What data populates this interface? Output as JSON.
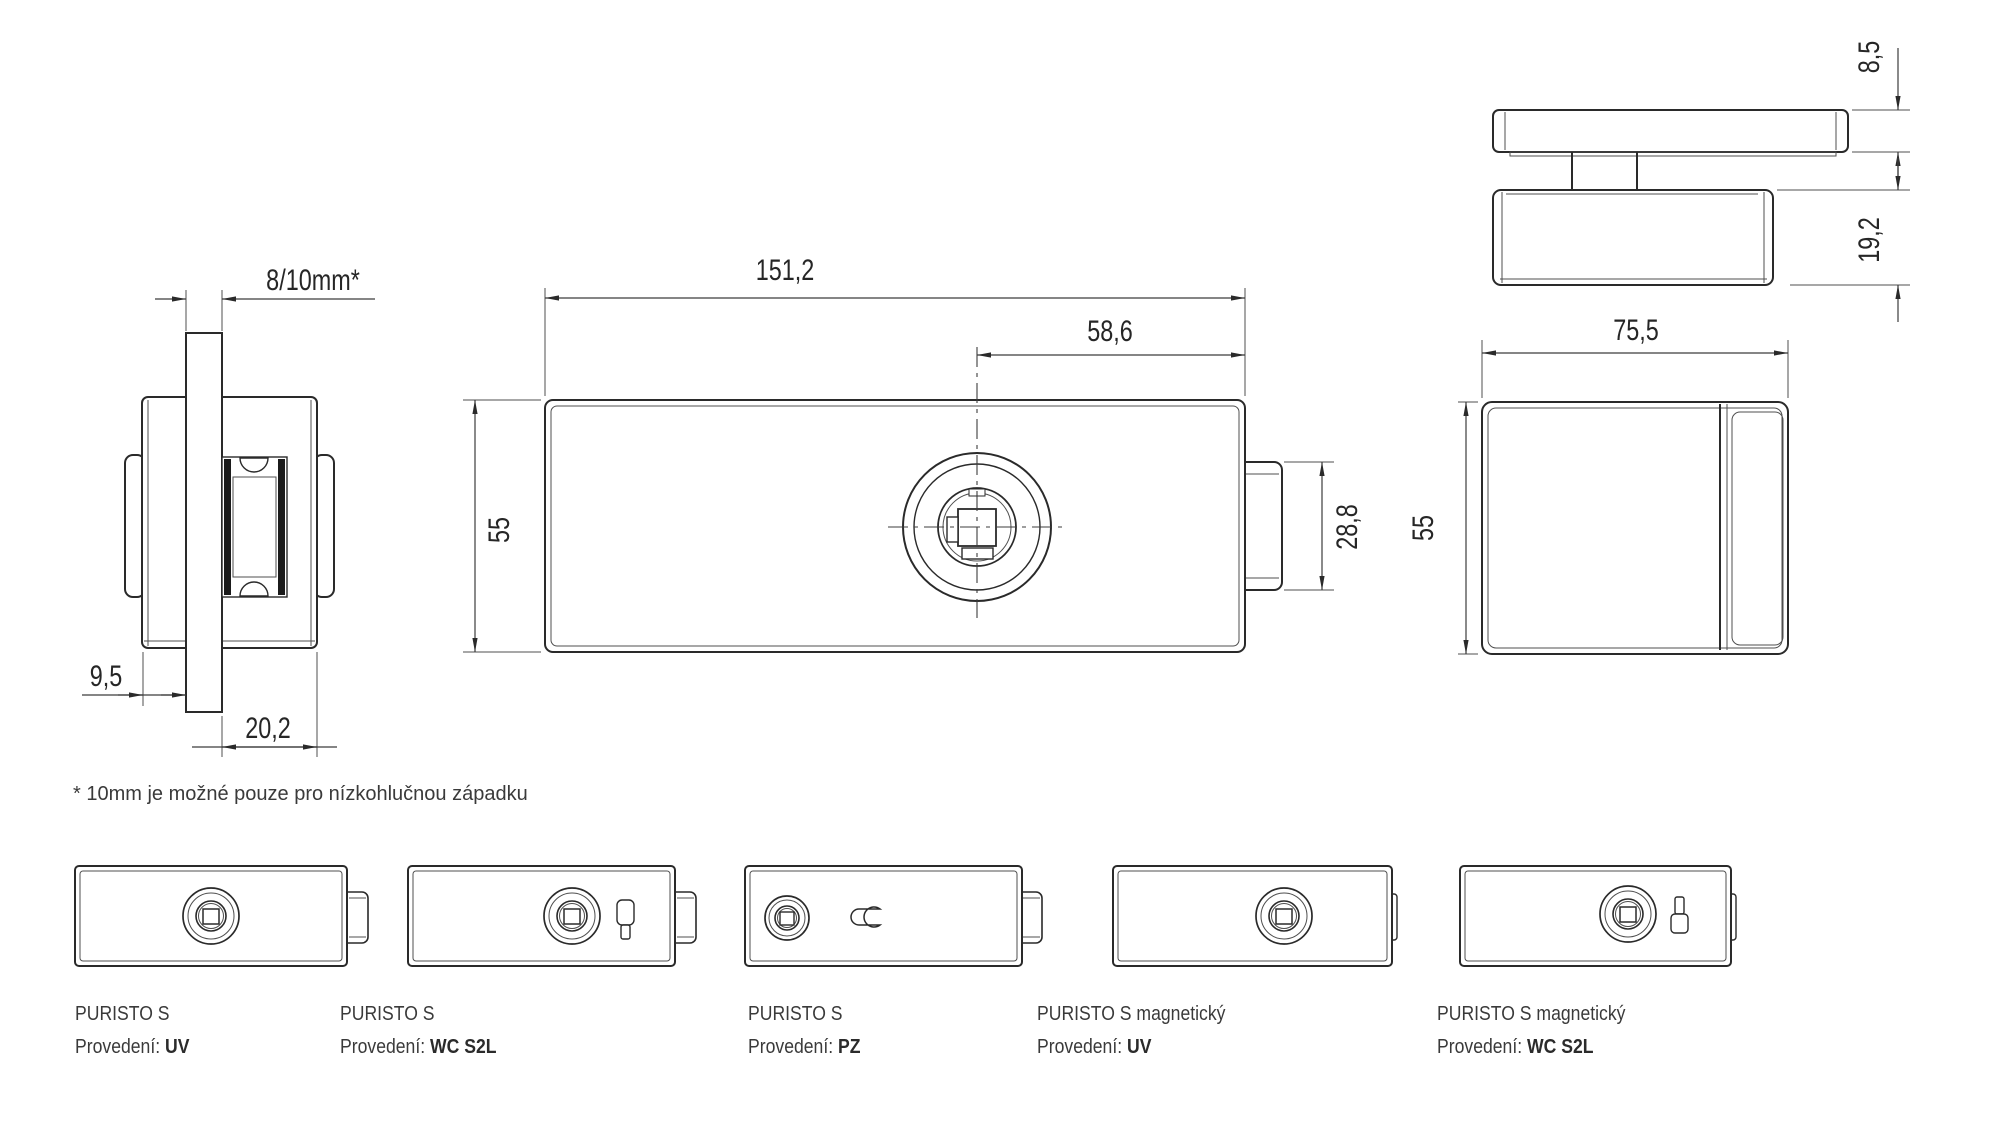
{
  "drawing": {
    "side_section_view": {
      "glass_thickness": "8/10mm*",
      "body_offset": "9,5",
      "body_depth": "20,2"
    },
    "front_view": {
      "width": "151,2",
      "spindle_offset": "58,6",
      "height": "55",
      "latch_height": "28,8"
    },
    "edge_section_view": {
      "cover_plate_thickness": "8,5",
      "body_plate_thickness": "19,2"
    },
    "side_view": {
      "width": "75,5",
      "height": "55"
    },
    "footnote": "* 10mm je možné pouze pro nízkohlučnou západku"
  },
  "variants": {
    "provedeni_label": "Provedení:",
    "items": [
      {
        "name": "PURISTO S",
        "provedeni": "UV"
      },
      {
        "name": "PURISTO S",
        "provedeni": "WC S2L"
      },
      {
        "name": "PURISTO S",
        "provedeni": "PZ"
      },
      {
        "name": "PURISTO S magnetický",
        "provedeni": "UV"
      },
      {
        "name": "PURISTO S magnetický",
        "provedeni": "WC S2L"
      }
    ]
  }
}
